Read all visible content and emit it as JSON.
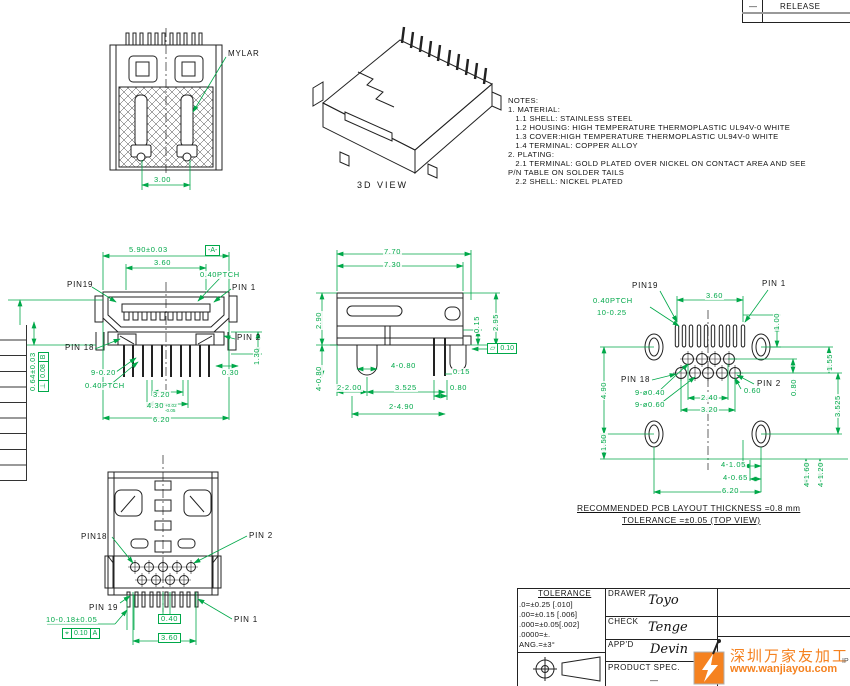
{
  "colors": {
    "dim_green": "#00A849",
    "line_black": "#222222",
    "watermark_orange": "#F58220",
    "release_divider_gray": "#999999"
  },
  "release_table": {
    "rev": "—",
    "label": "RELEASE"
  },
  "rear_view": {
    "labels": [
      {
        "t": "MYLAR",
        "cls": "blk",
        "x": 227,
        "y": 50,
        "name": "mylar-label"
      },
      {
        "t": "3.00",
        "x": 153,
        "y": 176
      }
    ]
  },
  "view_3d": {
    "caption": "3D VIEW"
  },
  "notes": {
    "lines": [
      "NOTES:",
      "1. MATERIAL:",
      "   1.1 SHELL: STAINLESS STEEL",
      "   1.2 HOUSING: HIGH TEMPERATURE THERMOPLASTIC UL94V-0 WHITE",
      "   1.3 COVER:HIGH TEMPERATURE THERMOPLASTIC UL94V-0 WHITE",
      "   1.4 TERMINAL: COPPER ALLOY",
      "2. PLATING:",
      "   2.1 TERMINAL: GOLD PLATED OVER NICKEL ON CONTACT AREA AND SEE",
      "P/N TABLE ON SOLDER TAILS",
      "   2.2 SHELL: NICKEL PLATED"
    ]
  },
  "front_view": {
    "labels": [
      {
        "t": "5.90±0.03",
        "x": 128,
        "y": 246
      },
      {
        "t": "3.60",
        "x": 153,
        "y": 259
      },
      {
        "t": "0.40PTCH",
        "x": 199,
        "y": 271
      },
      {
        "t": "PIN19",
        "cls": "blk",
        "x": 66,
        "y": 281,
        "name": "pin19-label"
      },
      {
        "t": "PIN 1",
        "cls": "blk",
        "x": 231,
        "y": 284,
        "name": "pin1-label"
      },
      {
        "t": "PIN 2",
        "cls": "blk",
        "x": 236,
        "y": 334,
        "name": "pin2-label"
      },
      {
        "t": "PIN 18",
        "cls": "blk",
        "x": 64,
        "y": 344,
        "name": "pin18-label"
      },
      {
        "t": "1.30",
        "x": 253,
        "y": 366,
        "rot": -90
      },
      {
        "t": "0.30",
        "x": 221,
        "y": 369
      },
      {
        "t": "9-0.20",
        "x": 90,
        "y": 369
      },
      {
        "t": "0.40PTCH",
        "x": 84,
        "y": 382
      },
      {
        "t": "3.20",
        "x": 152,
        "y": 391
      },
      {
        "t": "4.30",
        "sup": "+0.02",
        "sub": "-0.05",
        "x": 146,
        "y": 402
      },
      {
        "t": "6.20",
        "x": 152,
        "y": 416
      },
      {
        "t": "2.30±0.03",
        "x": 13,
        "y": 384,
        "rot": -90
      },
      {
        "t": "0.64±0.03",
        "x": 29,
        "y": 392,
        "rot": -90
      }
    ]
  },
  "side_view": {
    "labels": [
      {
        "t": "7.70",
        "x": 383,
        "y": 248
      },
      {
        "t": "7.30",
        "x": 383,
        "y": 261
      },
      {
        "t": "2.90",
        "x": 315,
        "y": 330,
        "rot": -90
      },
      {
        "t": "4-0.80",
        "x": 315,
        "y": 392,
        "rot": -90
      },
      {
        "t": "4-0.80",
        "x": 390,
        "y": 362
      },
      {
        "t": "2-2.00",
        "x": 336,
        "y": 384
      },
      {
        "t": "3.525",
        "x": 394,
        "y": 384
      },
      {
        "t": "0.15",
        "x": 452,
        "y": 368
      },
      {
        "t": "0.80",
        "x": 449,
        "y": 384
      },
      {
        "t": "2-4.90",
        "x": 388,
        "y": 403
      },
      {
        "t": "0.15",
        "x": 473,
        "y": 334,
        "rot": -90
      },
      {
        "t": "2.95",
        "x": 492,
        "y": 332,
        "rot": -90
      }
    ]
  },
  "pcb_view": {
    "labels": [
      {
        "t": "PIN19",
        "cls": "blk",
        "x": 631,
        "y": 282,
        "name": "pin19-label"
      },
      {
        "t": "PIN 1",
        "cls": "blk",
        "x": 761,
        "y": 280,
        "name": "pin1-label"
      },
      {
        "t": "PIN 18",
        "cls": "blk",
        "x": 620,
        "y": 376,
        "name": "pin18-label"
      },
      {
        "t": "PIN 2",
        "cls": "blk",
        "x": 756,
        "y": 380,
        "name": "pin2-label"
      },
      {
        "t": "3.60",
        "x": 705,
        "y": 292
      },
      {
        "t": "0.40PTCH",
        "x": 592,
        "y": 297
      },
      {
        "t": "10-0.25",
        "x": 596,
        "y": 309
      },
      {
        "t": "1.00",
        "x": 773,
        "y": 331,
        "rot": -90
      },
      {
        "t": "1.55",
        "x": 826,
        "y": 372,
        "rot": -90
      },
      {
        "t": "0.80",
        "x": 790,
        "y": 397,
        "rot": -90
      },
      {
        "t": "0.60",
        "x": 743,
        "y": 387
      },
      {
        "t": "9-ø0.40",
        "x": 634,
        "y": 389
      },
      {
        "t": "9-ø0.60",
        "x": 634,
        "y": 401
      },
      {
        "t": "2.40",
        "x": 700,
        "y": 394
      },
      {
        "t": "3.20",
        "x": 700,
        "y": 406
      },
      {
        "t": "4.90",
        "x": 600,
        "y": 400,
        "rot": -90
      },
      {
        "t": "1.50",
        "x": 600,
        "y": 452,
        "rot": -90
      },
      {
        "t": "3.525",
        "x": 834,
        "y": 418,
        "rot": -90
      },
      {
        "t": "4-1.05",
        "x": 720,
        "y": 461
      },
      {
        "t": "4-0.65",
        "x": 722,
        "y": 474
      },
      {
        "t": "6.20",
        "x": 721,
        "y": 487
      },
      {
        "t": "4-1.60",
        "x": 803,
        "y": 488,
        "rot": -90
      },
      {
        "t": "4-1.20",
        "x": 817,
        "y": 488,
        "rot": -90
      }
    ],
    "note1": "RECOMMENDED PCB LAYOUT THICKNESS =0.8 mm",
    "note2": "TOLERANCE =±0.05 (TOP VIEW)"
  },
  "bottom_view": {
    "labels": [
      {
        "t": "PIN18",
        "cls": "blk",
        "x": 80,
        "y": 533,
        "name": "pin18-label"
      },
      {
        "t": "PIN 2",
        "cls": "blk",
        "x": 248,
        "y": 532,
        "name": "pin2-label"
      },
      {
        "t": "PIN 19",
        "cls": "blk",
        "x": 88,
        "y": 604,
        "name": "pin19-label"
      },
      {
        "t": "PIN 1",
        "cls": "blk",
        "x": 233,
        "y": 616,
        "name": "pin1-label"
      },
      {
        "t": "10-0.18±0.05",
        "x": 45,
        "y": 616
      },
      {
        "t": "0.40",
        "x": 158,
        "y": 614,
        "box": true
      },
      {
        "t": "3.60",
        "x": 158,
        "y": 633,
        "box": true
      }
    ]
  },
  "gdt": {
    "perp": {
      "sym": "⊥",
      "tol": "0.08",
      "datum": "B"
    },
    "flat": {
      "sym": "▱",
      "tol": "0.10"
    },
    "pos": {
      "sym": "⌖",
      "tol": "0.10",
      "datum": "A"
    },
    "datum_a": "-A-",
    "datum_b": "-B-"
  },
  "title_block": {
    "tolerance_title": "TOLERANCE",
    "tol_lines": [
      ".0=±0.25 [.010]",
      ".00=±0.15 [.006]",
      ".000=±0.05[.002]",
      ".0000=±.",
      "ANG.=±3°"
    ],
    "rows": [
      {
        "label": "DRAWER",
        "name": "Toyo"
      },
      {
        "label": "CHECK",
        "name": "Tenge"
      },
      {
        "label": "APP'D",
        "name": "Devin"
      },
      {
        "label": "PRODUCT SPEC.",
        "name": "—"
      }
    ]
  },
  "watermark": {
    "cn": "深圳万家友加工网",
    "url": "www.wanjiayou.com",
    "edge_text": "IP"
  }
}
